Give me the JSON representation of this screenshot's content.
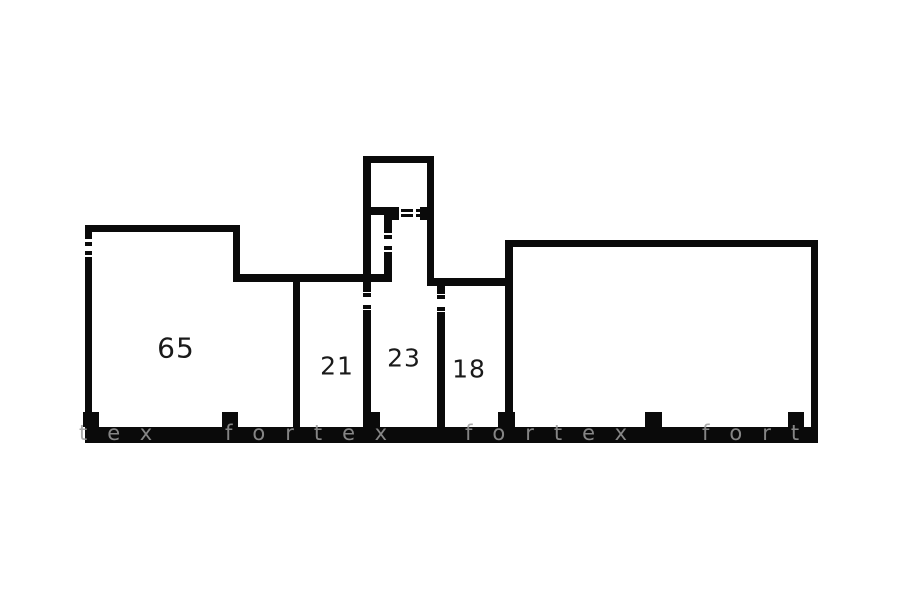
{
  "page": {
    "background_color": "#ffffff",
    "type": "floor-plan"
  },
  "floorplan": {
    "wall_color": "#0a0a0a",
    "label_color": "#1a1a1a",
    "watermark_color": "#9b9b9b",
    "rooms": [
      {
        "label": "65",
        "cx": 176,
        "cy": 348,
        "font_size": 28
      },
      {
        "label": "21",
        "cx": 337,
        "cy": 366,
        "font_size": 25
      },
      {
        "label": "23",
        "cx": 404,
        "cy": 358,
        "font_size": 25
      },
      {
        "label": "18",
        "cx": 469,
        "cy": 369,
        "font_size": 25
      }
    ],
    "walls": [
      {
        "name": "bottom-wall",
        "x": 85,
        "y": 427,
        "w": 733,
        "h": 16
      },
      {
        "name": "left-wall-upper",
        "x": 85,
        "y": 225,
        "w": 7,
        "h": 14
      },
      {
        "name": "left-window-tick-1",
        "x": 85,
        "y": 242,
        "w": 7,
        "h": 4
      },
      {
        "name": "left-window-tick-2",
        "x": 85,
        "y": 251,
        "w": 7,
        "h": 4
      },
      {
        "name": "left-wall-lower",
        "x": 85,
        "y": 257,
        "w": 7,
        "h": 170
      },
      {
        "name": "room65-top-wall",
        "x": 85,
        "y": 225,
        "w": 155,
        "h": 7
      },
      {
        "name": "room65-step-wall",
        "x": 233,
        "y": 231,
        "w": 7,
        "h": 44
      },
      {
        "name": "hall-top-wall",
        "x": 233,
        "y": 274,
        "w": 159,
        "h": 8
      },
      {
        "name": "divider-65-21",
        "x": 293,
        "y": 282,
        "w": 7,
        "h": 145
      },
      {
        "name": "tower-top-wall",
        "x": 363,
        "y": 156,
        "w": 71,
        "h": 7
      },
      {
        "name": "tower-left-wall",
        "x": 363,
        "y": 156,
        "w": 8,
        "h": 118
      },
      {
        "name": "tower-right-wall",
        "x": 427,
        "y": 156,
        "w": 7,
        "h": 122
      },
      {
        "name": "closet-top-wall",
        "x": 363,
        "y": 207,
        "w": 29,
        "h": 8
      },
      {
        "name": "closet-right-wall-upper",
        "x": 384,
        "y": 215,
        "w": 8,
        "h": 18
      },
      {
        "name": "closet-window-tick-1",
        "x": 384,
        "y": 235,
        "w": 8,
        "h": 4
      },
      {
        "name": "closet-window-tick-2",
        "x": 384,
        "y": 246,
        "w": 8,
        "h": 4
      },
      {
        "name": "closet-right-wall-lower",
        "x": 384,
        "y": 252,
        "w": 8,
        "h": 22
      },
      {
        "name": "door-jamb-left",
        "x": 392,
        "y": 207,
        "w": 7,
        "h": 13
      },
      {
        "name": "door-dash-1a",
        "x": 401,
        "y": 209,
        "w": 12,
        "h": 3
      },
      {
        "name": "door-dash-1b",
        "x": 401,
        "y": 214,
        "w": 12,
        "h": 3
      },
      {
        "name": "door-dash-2a",
        "x": 416,
        "y": 209,
        "w": 11,
        "h": 3
      },
      {
        "name": "door-dash-2b",
        "x": 416,
        "y": 214,
        "w": 11,
        "h": 3
      },
      {
        "name": "door-jamb-right",
        "x": 420,
        "y": 207,
        "w": 7,
        "h": 13
      },
      {
        "name": "divider-21-23-stub",
        "x": 363,
        "y": 282,
        "w": 8,
        "h": 10
      },
      {
        "name": "divider-21-23-tick-1",
        "x": 363,
        "y": 293,
        "w": 8,
        "h": 4
      },
      {
        "name": "divider-21-23-tick-2",
        "x": 363,
        "y": 305,
        "w": 8,
        "h": 4
      },
      {
        "name": "divider-21-23",
        "x": 363,
        "y": 310,
        "w": 8,
        "h": 117
      },
      {
        "name": "room18-top-wall",
        "x": 427,
        "y": 278,
        "w": 86,
        "h": 8
      },
      {
        "name": "divider-23-18-stub",
        "x": 437,
        "y": 286,
        "w": 8,
        "h": 8
      },
      {
        "name": "divider-23-18-tick-1",
        "x": 437,
        "y": 295,
        "w": 8,
        "h": 4
      },
      {
        "name": "divider-23-18-tick-2",
        "x": 437,
        "y": 307,
        "w": 8,
        "h": 4
      },
      {
        "name": "divider-23-18",
        "x": 437,
        "y": 312,
        "w": 8,
        "h": 115
      },
      {
        "name": "bigroom-top-wall",
        "x": 505,
        "y": 240,
        "w": 313,
        "h": 7
      },
      {
        "name": "divider-18-bigroom",
        "x": 505,
        "y": 240,
        "w": 8,
        "h": 187
      },
      {
        "name": "bigroom-right-wall",
        "x": 811,
        "y": 240,
        "w": 7,
        "h": 187
      },
      {
        "name": "pillar-1",
        "x": 83,
        "y": 412,
        "w": 16,
        "h": 15
      },
      {
        "name": "pillar-2",
        "x": 222,
        "y": 412,
        "w": 16,
        "h": 15
      },
      {
        "name": "pillar-3",
        "x": 363,
        "y": 412,
        "w": 17,
        "h": 15
      },
      {
        "name": "pillar-4",
        "x": 498,
        "y": 412,
        "w": 17,
        "h": 15
      },
      {
        "name": "pillar-5",
        "x": 645,
        "y": 412,
        "w": 17,
        "h": 15
      },
      {
        "name": "pillar-6",
        "x": 788,
        "y": 412,
        "w": 16,
        "h": 15
      }
    ],
    "watermark": {
      "brand": "fortex",
      "words": [
        {
          "text": "tex",
          "x": 79
        },
        {
          "text": "fortex",
          "x": 225
        },
        {
          "text": "fortex",
          "x": 465
        },
        {
          "text": "fort",
          "x": 702
        }
      ],
      "y": 423,
      "font_size": 21,
      "letter_spacing": 20
    }
  }
}
